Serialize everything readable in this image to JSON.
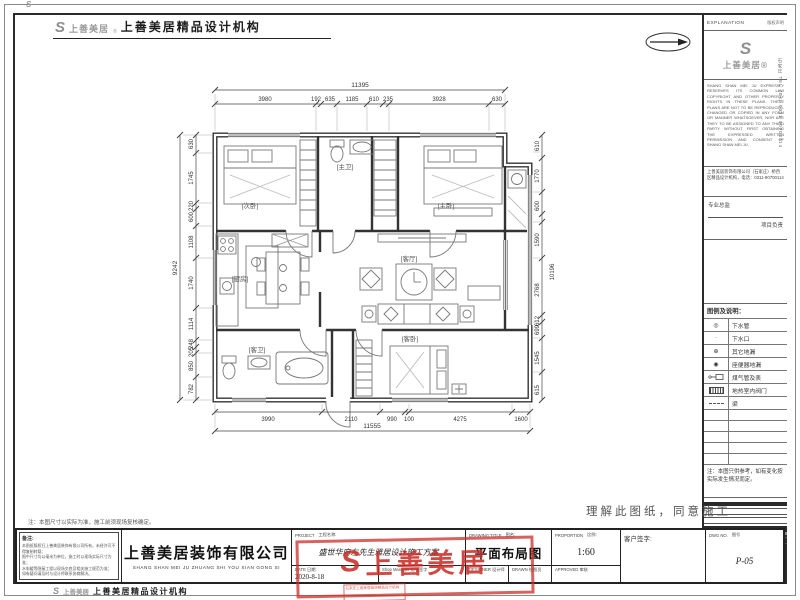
{
  "header": {
    "logo_mark": "S",
    "logo_word": "上善美居",
    "reg": "®",
    "brand": "上善美居精品设计机构"
  },
  "right_panel": {
    "explanation_title": "EXPLANATION",
    "explanation_side": "版权声明",
    "logo_mark": "S",
    "logo_word": "上善美居®",
    "legal_en": "SHANG SHAN MEI JU EXPRESSLY RESERVES ITS COMMON LAW COPYRIGHT AND OTHER PROPERTY RIGHTS IN THESE PLANS. THESE PLANS ARE NOT TO BE REPRODUCED, CHANGED OR COPIED IN ANY FORM OR MANNER WHATSOEVER, NOR ARE THEY TO BE ASSIGNED TO ANY THIRD PARTY WITHOUT FIRST OBTAINING THE EXPRESSED WRITTEN PERMISSION AND CONSENT OF SHANG SHAN MEI JU.",
    "address_cn": "上善美居装饰有限公司（石家庄）桥西区精品设计机构，电话：0311-90700114",
    "director_label": "专业总监",
    "manager_label": "项目负责",
    "side_vertical": "石家庄 TEL（06）0311 90700114",
    "legend_title": "图例及说明：",
    "legend": [
      {
        "glyph": "◎",
        "label": "下水管"
      },
      {
        "glyph": "·",
        "label": "下水口"
      },
      {
        "glyph": "⊕",
        "label": "其它地漏"
      },
      {
        "glyph": "◉",
        "label": "座便器地漏"
      },
      {
        "glyph": "",
        "label": "煤气管及表"
      },
      {
        "glyph": "",
        "label": "地热室内阀门"
      },
      {
        "glyph": "",
        "label": "梁"
      }
    ],
    "note": "注：本图只供参考，如有变化按实际发生情况而定。"
  },
  "plan": {
    "room_labels": [
      "[次卧]",
      "[主卫]",
      "[主卧]",
      "[厨房]",
      "[客厅]",
      "[客卫]",
      "[客卧]"
    ],
    "dims": {
      "top_total": "11395",
      "top": [
        "3980",
        "192",
        "635",
        "1185",
        "610",
        "235",
        "3928",
        "630"
      ],
      "left_total": "9242",
      "left": [
        "630",
        "1745",
        "220",
        "600",
        "1108",
        "1740",
        "1114",
        "248",
        "205",
        "850",
        "782"
      ],
      "right": [
        "610",
        "1770",
        "600",
        "1590",
        "2768",
        "612",
        "699",
        "1545",
        "615"
      ],
      "right_inner": "10196",
      "bottom": [
        "3990",
        "2110",
        "990",
        "100",
        "4275",
        "1600"
      ],
      "bottom_total": "11555"
    }
  },
  "titlebar": {
    "remark_title": "备注:",
    "remark_lines": [
      "本图纸版权归上善美居装饰有限公司所有，未经许可不得复制转载；",
      "图中尺寸均以毫米为单位，施工时以现场实际尺寸为准；",
      "水电暖等隐蔽工程以现场交底及相关施工规范为准；",
      "如有疑问请及时与设计师联系协商解决。"
    ],
    "company_cn": "上善美居装饰有限公司",
    "company_en": "SHANG SHAN MEI JU ZHUANG SHI YOU XIAN GONG SI",
    "project_label": "PROJECT",
    "project_label_cn": "工程名称:",
    "project_value": "盛世华府左先生雅居设计施工方案",
    "date_label": "DATE",
    "date_label_cn": "日期:",
    "date_value": "2020-8-18",
    "manager_label": "Shop Manager",
    "manager_label_cn": "店长签字",
    "drawing_title_label": "DRAWING TITLE",
    "drawing_title_label_cn": "图名:",
    "drawing_title": "平面布局图",
    "designer_label": "DESIGNER",
    "designer_label_cn": "设计师",
    "drawn_label": "DRAWN",
    "drawn_label_cn": "绘图员",
    "proportion_label": "PROPORTION",
    "proportion_label_cn": "比例:",
    "proportion_value": "1:60",
    "approved_label": "APPROVED",
    "approved_label_cn": "审核",
    "client_label": "客户签字:",
    "dwg_label": "DWG NO.",
    "dwg_label_cn": "图号",
    "dwg_value": "P-05"
  },
  "stamp": {
    "mark": "S",
    "text": "上善美居",
    "sub": "石家庄上善美居装饰精品设计机构"
  },
  "agree_text": "理解此图纸，同意施工",
  "note_above_bar": "注：本图尺寸以实际为准，施工前须现场复核确定。",
  "footer": {
    "logo_mark": "S",
    "logo_word": "上善美居",
    "brand": "上善美居精品设计机构"
  }
}
